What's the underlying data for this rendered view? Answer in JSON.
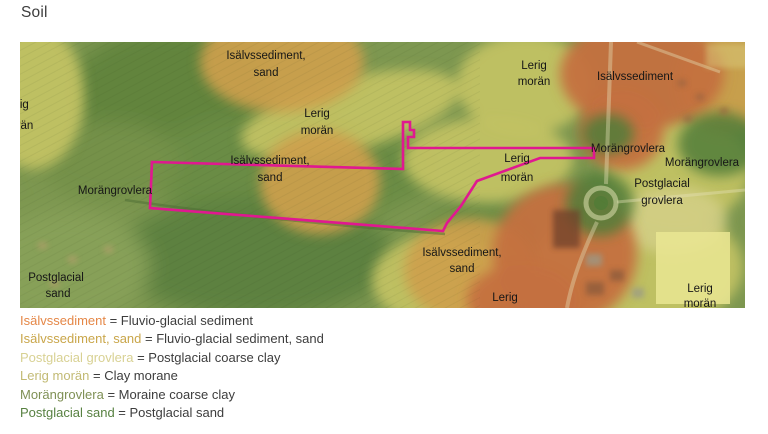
{
  "page": {
    "title": "Soil"
  },
  "map": {
    "route_color": "#e01890",
    "labels": [
      {
        "line1": "Lerig",
        "line2": "morän"
      },
      {
        "line1": "Isälvssediment,",
        "line2": "sand"
      },
      {
        "line1": "Lerig",
        "line2": "morän"
      },
      {
        "line1": "Isälvssediment,",
        "line2": "sand"
      },
      {
        "line1": "Lerig",
        "line2": "morän"
      },
      {
        "line1": "Isälvssediment"
      },
      {
        "line1": "Lerig",
        "line2": "morän"
      },
      {
        "line1": "Morängrovlera"
      },
      {
        "line1": "Morängrovlera"
      },
      {
        "line1": "Postglacial",
        "line2": "grovlera"
      },
      {
        "line1": "Lerig",
        "line2": "morän"
      },
      {
        "line1": "Morängrovlera"
      },
      {
        "line1": "Postglacial",
        "line2": "sand"
      },
      {
        "line1": "Isälvssediment,",
        "line2": "sand"
      },
      {
        "line1": "Lerig"
      }
    ]
  },
  "soil_colors": {
    "isalvssediment": "#c4703f",
    "isalvssediment_sand": "#cda04c",
    "postglacial_grovlera": "#d5cf89",
    "lerig_moran": "#c2c263",
    "morangrovlera": "#84935a",
    "postglacial_sand": "#527c38"
  },
  "legend": {
    "items": [
      {
        "term": "Isälvssediment",
        "rest": " = Fluvio-glacial sediment",
        "color": "#e58747"
      },
      {
        "term": "Isälvssediment, sand",
        "rest": " = Fluvio-glacial sediment, sand",
        "color": "#c9a64a"
      },
      {
        "term": "Postglacial grovlera",
        "rest": " = Postglacial coarse clay",
        "color": "#d8d193"
      },
      {
        "term": "Lerig morän",
        "rest": " = Clay morane",
        "color": "#c2ba74"
      },
      {
        "term": "Morängrovlera",
        "rest": " = Moraine coarse clay",
        "color": "#7f9055"
      },
      {
        "term": "Postglacial sand",
        "rest": " = Postglacial sand",
        "color": "#578141"
      }
    ]
  }
}
